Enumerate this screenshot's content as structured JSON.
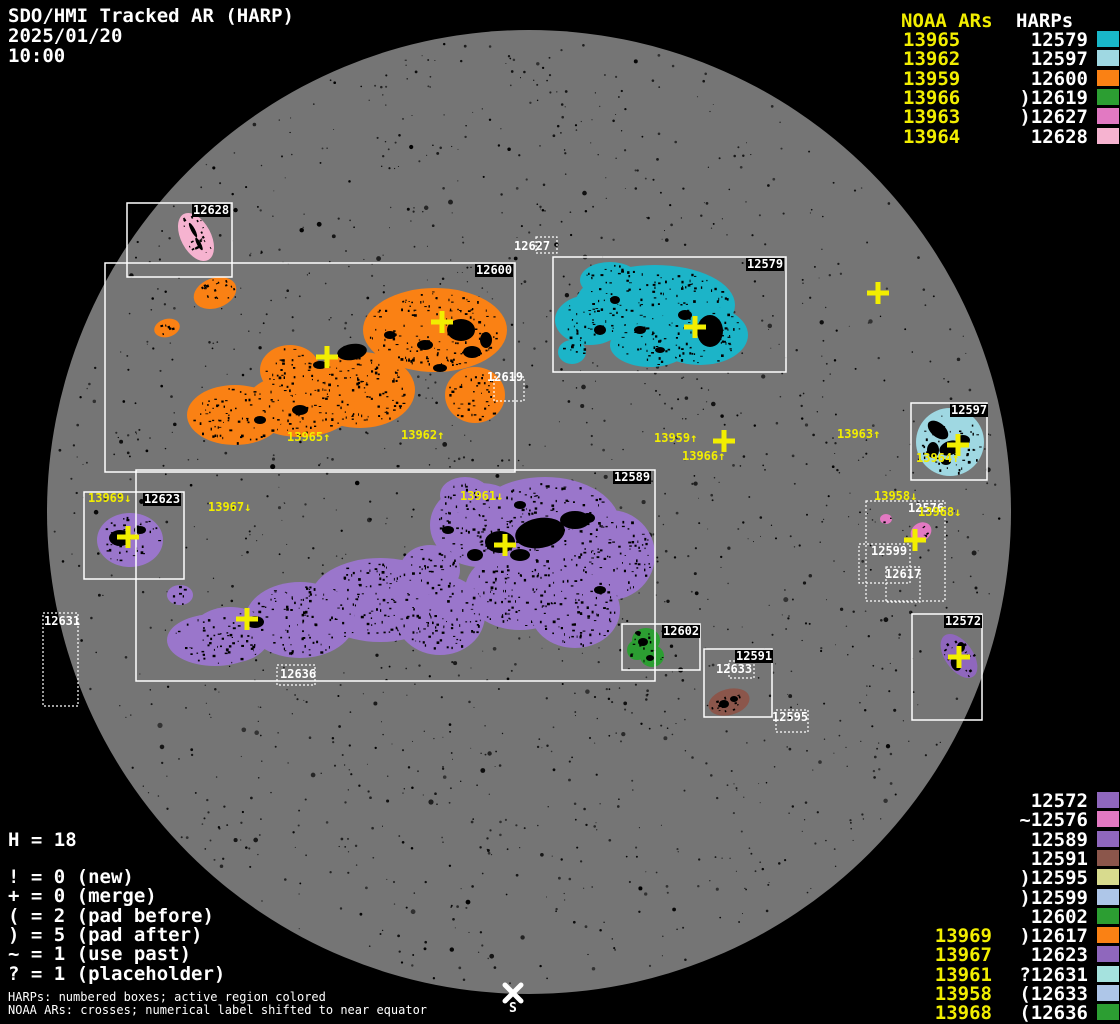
{
  "app": {
    "title": "SDO/HMI Tracked AR (HARP)",
    "date": "2025/01/20",
    "time": "10:00"
  },
  "top_legend": {
    "noaa_header": "NOAA ARs",
    "harps_header": "HARPs",
    "rows": [
      {
        "noaa": "13965",
        "harp": "12579",
        "color": "#19b7c9"
      },
      {
        "noaa": "13962",
        "harp": "12597",
        "color": "#9fd8e2"
      },
      {
        "noaa": "13959",
        "harp": "12600",
        "color": "#fa8114"
      },
      {
        "noaa": "13966",
        "harp": ")12619",
        "color": "#2c9e32"
      },
      {
        "noaa": "13963",
        "harp": ")12627",
        "color": "#e279c2"
      },
      {
        "noaa": "13964",
        "harp": "12628",
        "color": "#f6b3d0"
      }
    ]
  },
  "bottom_legend": {
    "rows": [
      {
        "noaa": "",
        "harp": "12572",
        "color": "#8f67bd"
      },
      {
        "noaa": "",
        "harp": "~12576",
        "color": "#e279c2"
      },
      {
        "noaa": "",
        "harp": "12589",
        "color": "#8f67bd"
      },
      {
        "noaa": "",
        "harp": "12591",
        "color": "#8b564b"
      },
      {
        "noaa": "",
        "harp": ")12595",
        "color": "#d8db8e"
      },
      {
        "noaa": "",
        "harp": ")12599",
        "color": "#aec6e8"
      },
      {
        "noaa": "",
        "harp": "12602",
        "color": "#2c9e32"
      },
      {
        "noaa": "13969",
        "harp": ")12617",
        "color": "#fa8114"
      },
      {
        "noaa": "13967",
        "harp": "12623",
        "color": "#8f67bd"
      },
      {
        "noaa": "13961",
        "harp": "?12631",
        "color": "#a5e2de"
      },
      {
        "noaa": "13958",
        "harp": "(12633",
        "color": "#aec6e8"
      },
      {
        "noaa": "13968",
        "harp": "(12636",
        "color": "#2c9e32"
      }
    ]
  },
  "stats": {
    "h_count": "H = 18",
    "lines": [
      "! = 0 (new)",
      "+ = 0 (merge)",
      "( = 2 (pad before)",
      ") = 5 (pad after)",
      "~ = 1 (use past)",
      "? = 1 (placeholder)"
    ]
  },
  "footer": {
    "line1": "HARPs: numbered boxes; active region colored",
    "line2": "NOAA ARs: crosses; numerical label shifted to near equator"
  },
  "south_marker": {
    "label": "S",
    "x": 513,
    "y": 993
  },
  "disk": {
    "cx": 529,
    "cy": 512,
    "r": 482,
    "color": "#757575"
  },
  "boxes": [
    {
      "harp": "12628",
      "x": 127,
      "y": 203,
      "w": 105,
      "h": 74,
      "style": "solid",
      "lx": 192,
      "ly": 204,
      "bg": true
    },
    {
      "harp": "12600",
      "x": 105,
      "y": 263,
      "w": 410,
      "h": 209,
      "style": "solid",
      "lx": 475,
      "ly": 264,
      "bg": true
    },
    {
      "harp": "12579",
      "x": 553,
      "y": 257,
      "w": 233,
      "h": 115,
      "style": "solid",
      "lx": 746,
      "ly": 258,
      "bg": true
    },
    {
      "harp": "12589",
      "x": 136,
      "y": 470,
      "w": 519,
      "h": 211,
      "style": "solid",
      "lx": 613,
      "ly": 471,
      "bg": true
    },
    {
      "harp": "12623",
      "x": 84,
      "y": 492,
      "w": 100,
      "h": 87,
      "style": "solid",
      "lx": 143,
      "ly": 493,
      "bg": true
    },
    {
      "harp": "12602",
      "x": 622,
      "y": 624,
      "w": 78,
      "h": 46,
      "style": "solid",
      "lx": 662,
      "ly": 625,
      "bg": true
    },
    {
      "harp": "12591",
      "x": 704,
      "y": 649,
      "w": 68,
      "h": 68,
      "style": "solid",
      "lx": 735,
      "ly": 650,
      "bg": true
    },
    {
      "harp": "12597",
      "x": 911,
      "y": 403,
      "w": 76,
      "h": 77,
      "style": "solid",
      "lx": 950,
      "ly": 404,
      "bg": true
    },
    {
      "harp": "12572",
      "x": 912,
      "y": 614,
      "w": 70,
      "h": 106,
      "style": "solid",
      "lx": 944,
      "ly": 615,
      "bg": true
    },
    {
      "harp": "12619",
      "x": 494,
      "y": 377,
      "w": 30,
      "h": 24,
      "style": "dotted",
      "lx": 487,
      "ly": 371,
      "bg": false
    },
    {
      "harp": "12627",
      "x": 536,
      "y": 237,
      "w": 21,
      "h": 16,
      "style": "dotted",
      "lx": 514,
      "ly": 240,
      "bg": false
    },
    {
      "harp": "12631",
      "x": 43,
      "y": 613,
      "w": 35,
      "h": 93,
      "style": "dotted",
      "lx": 44,
      "ly": 615,
      "bg": false
    },
    {
      "harp": "12636",
      "x": 277,
      "y": 665,
      "w": 38,
      "h": 20,
      "style": "dotted",
      "lx": 280,
      "ly": 668,
      "bg": false
    },
    {
      "harp": "12633",
      "x": 729,
      "y": 661,
      "w": 25,
      "h": 17,
      "style": "dotted",
      "lx": 716,
      "ly": 663,
      "bg": false
    },
    {
      "harp": "12595",
      "x": 776,
      "y": 710,
      "w": 32,
      "h": 22,
      "style": "dotted",
      "lx": 772,
      "ly": 711,
      "bg": false
    },
    {
      "harp": "12576",
      "x": 866,
      "y": 501,
      "w": 79,
      "h": 100,
      "style": "dotted",
      "lx": 908,
      "ly": 502,
      "bg": false
    },
    {
      "harp": "12599",
      "x": 859,
      "y": 544,
      "w": 51,
      "h": 39,
      "style": "dotted",
      "lx": 871,
      "ly": 545,
      "bg": false
    },
    {
      "harp": "12617",
      "x": 886,
      "y": 567,
      "w": 34,
      "h": 35,
      "style": "dotted",
      "lx": 885,
      "ly": 568,
      "bg": false
    }
  ],
  "regions": [
    {
      "harp": "12600",
      "color": "#fa8114",
      "ellipses": [
        [
          435,
          330,
          72,
          42,
          0
        ],
        [
          360,
          390,
          55,
          38,
          0
        ],
        [
          300,
          405,
          55,
          32,
          0
        ],
        [
          235,
          415,
          48,
          30,
          0
        ],
        [
          290,
          370,
          30,
          25,
          0
        ],
        [
          475,
          395,
          30,
          28,
          0
        ],
        [
          215,
          293,
          22,
          15,
          -20
        ],
        [
          167,
          328,
          13,
          9,
          -15
        ]
      ],
      "spots": [
        [
          352,
          352,
          15,
          8,
          -10
        ],
        [
          461,
          330,
          14,
          11,
          0
        ],
        [
          472,
          352,
          9,
          6,
          0
        ],
        [
          425,
          345,
          8,
          5,
          0
        ],
        [
          390,
          335,
          6,
          4,
          0
        ],
        [
          320,
          365,
          7,
          4,
          0
        ],
        [
          300,
          410,
          8,
          5,
          0
        ],
        [
          260,
          420,
          6,
          4,
          0
        ],
        [
          440,
          368,
          7,
          4,
          0
        ],
        [
          486,
          340,
          6,
          8,
          0
        ]
      ]
    },
    {
      "harp": "12579",
      "color": "#1cb4c8",
      "ellipses": [
        [
          655,
          305,
          80,
          40,
          0
        ],
        [
          610,
          280,
          30,
          18,
          0
        ],
        [
          590,
          320,
          35,
          25,
          0
        ],
        [
          700,
          335,
          48,
          30,
          0
        ],
        [
          650,
          345,
          40,
          22,
          0
        ],
        [
          572,
          352,
          14,
          12,
          0
        ]
      ],
      "spots": [
        [
          710,
          331,
          13,
          16,
          0
        ],
        [
          685,
          315,
          7,
          5,
          0
        ],
        [
          640,
          330,
          6,
          4,
          0
        ],
        [
          615,
          300,
          5,
          4,
          0
        ],
        [
          600,
          330,
          6,
          5,
          0
        ],
        [
          660,
          350,
          5,
          3,
          0
        ]
      ]
    },
    {
      "harp": "12589",
      "color": "#9a76cb",
      "ellipses": [
        [
          545,
          525,
          75,
          48,
          0
        ],
        [
          610,
          555,
          45,
          45,
          0
        ],
        [
          480,
          525,
          50,
          42,
          0
        ],
        [
          465,
          495,
          25,
          18,
          0
        ],
        [
          520,
          590,
          55,
          40,
          0
        ],
        [
          575,
          610,
          45,
          38,
          0
        ],
        [
          380,
          600,
          70,
          42,
          0
        ],
        [
          300,
          620,
          55,
          38,
          0
        ],
        [
          230,
          635,
          40,
          28,
          0
        ],
        [
          440,
          615,
          45,
          40,
          0
        ],
        [
          430,
          570,
          30,
          25,
          0
        ],
        [
          215,
          640,
          48,
          26,
          0
        ],
        [
          180,
          595,
          13,
          10,
          0
        ]
      ],
      "spots": [
        [
          540,
          533,
          25,
          15,
          -10
        ],
        [
          500,
          542,
          15,
          11,
          0
        ],
        [
          575,
          520,
          15,
          9,
          0
        ],
        [
          475,
          555,
          8,
          6,
          0
        ],
        [
          520,
          555,
          10,
          6,
          0
        ],
        [
          588,
          518,
          7,
          5,
          0
        ],
        [
          448,
          530,
          6,
          4,
          0
        ],
        [
          255,
          622,
          9,
          6,
          0
        ],
        [
          520,
          505,
          6,
          4,
          0
        ],
        [
          600,
          590,
          6,
          4,
          0
        ]
      ]
    },
    {
      "harp": "12623",
      "color": "#9a76cb",
      "ellipses": [
        [
          130,
          540,
          33,
          27,
          0
        ]
      ],
      "spots": [
        [
          120,
          538,
          11,
          8,
          0
        ],
        [
          140,
          530,
          6,
          4,
          0
        ]
      ]
    },
    {
      "harp": "12628",
      "color": "#f6b3d0",
      "ellipses": [
        [
          196,
          237,
          15,
          26,
          -28
        ]
      ],
      "spots": [
        [
          193,
          230,
          2,
          8,
          -28
        ],
        [
          199,
          244,
          2,
          7,
          -28
        ]
      ]
    },
    {
      "harp": "12597",
      "color": "#9fd8e2",
      "ellipses": [
        [
          950,
          442,
          34,
          34,
          0
        ]
      ],
      "spots": [
        [
          938,
          430,
          12,
          7,
          40
        ],
        [
          950,
          448,
          11,
          7,
          -20
        ],
        [
          933,
          450,
          6,
          8,
          0
        ],
        [
          963,
          440,
          7,
          5,
          0
        ],
        [
          946,
          462,
          5,
          3,
          0
        ]
      ]
    },
    {
      "harp": "12602",
      "color": "#2c9e32",
      "ellipses": [
        [
          646,
          640,
          14,
          12,
          0
        ],
        [
          652,
          656,
          12,
          11,
          0
        ],
        [
          637,
          650,
          10,
          10,
          0
        ]
      ],
      "spots": [
        [
          643,
          642,
          5,
          4,
          0
        ],
        [
          650,
          658,
          4,
          3,
          0
        ],
        [
          638,
          633,
          3,
          2,
          0
        ]
      ]
    },
    {
      "harp": "12591",
      "color": "#8b564b",
      "ellipses": [
        [
          729,
          702,
          21,
          13,
          -15
        ]
      ],
      "spots": [
        [
          724,
          704,
          5,
          4,
          0
        ],
        [
          734,
          699,
          4,
          3,
          0
        ]
      ]
    },
    {
      "harp": "12572",
      "color": "#8f67bd",
      "ellipses": [
        [
          959,
          656,
          14,
          25,
          -35
        ]
      ],
      "spots": [
        [
          956,
          664,
          5,
          7,
          -20
        ],
        [
          961,
          647,
          4,
          5,
          0
        ]
      ]
    },
    {
      "harp": "12576",
      "color": "#e279c2",
      "ellipses": [
        [
          886,
          519,
          6,
          5,
          0
        ],
        [
          921,
          532,
          11,
          9,
          -35
        ]
      ],
      "spots": []
    }
  ],
  "crosses": [
    [
      327,
      357
    ],
    [
      442,
      322
    ],
    [
      695,
      327
    ],
    [
      724,
      441
    ],
    [
      878,
      293
    ],
    [
      958,
      445
    ],
    [
      128,
      537
    ],
    [
      247,
      619
    ],
    [
      505,
      545
    ],
    [
      915,
      540
    ],
    [
      959,
      657
    ]
  ],
  "ar_labels": [
    {
      "text": "13965↑",
      "x": 287,
      "y": 431
    },
    {
      "text": "13962↑",
      "x": 401,
      "y": 429
    },
    {
      "text": "13959↑",
      "x": 654,
      "y": 432
    },
    {
      "text": "13966↑",
      "x": 682,
      "y": 450
    },
    {
      "text": "13963↑",
      "x": 837,
      "y": 428
    },
    {
      "text": "13964↑",
      "x": 916,
      "y": 452
    },
    {
      "text": "13961↓",
      "x": 460,
      "y": 490
    },
    {
      "text": "13967↓",
      "x": 208,
      "y": 501
    },
    {
      "text": "13969↓",
      "x": 88,
      "y": 492
    },
    {
      "text": "13958↓",
      "x": 874,
      "y": 490
    },
    {
      "text": "13968↓",
      "x": 918,
      "y": 506
    }
  ],
  "chart_data": {
    "type": "table",
    "title": "SDO/HMI Tracked AR (HARP) 2025/01/20 10:00",
    "columns": [
      "NOAA AR",
      "HARP",
      "flag"
    ],
    "rows": [
      [
        "13965",
        "12579",
        ""
      ],
      [
        "13962",
        "12597",
        ""
      ],
      [
        "13959",
        "12600",
        ""
      ],
      [
        "13966",
        "12619",
        "pad after"
      ],
      [
        "13963",
        "12627",
        "pad after"
      ],
      [
        "13964",
        "12628",
        ""
      ],
      [
        "13969",
        "12617",
        "pad after"
      ],
      [
        "13967",
        "12623",
        ""
      ],
      [
        "13961",
        "12631",
        "placeholder"
      ],
      [
        "13958",
        "12633",
        "pad before"
      ],
      [
        "13968",
        "12636",
        "pad before"
      ],
      [
        "",
        "12572",
        ""
      ],
      [
        "",
        "12576",
        "use past"
      ],
      [
        "",
        "12589",
        ""
      ],
      [
        "",
        "12591",
        ""
      ],
      [
        "",
        "12595",
        "pad after"
      ],
      [
        "",
        "12599",
        "pad after"
      ],
      [
        "",
        "12602",
        ""
      ]
    ],
    "counts": {
      "H": 18,
      "new": 0,
      "merge": 0,
      "pad_before": 2,
      "pad_after": 5,
      "use_past": 1,
      "placeholder": 1
    }
  }
}
